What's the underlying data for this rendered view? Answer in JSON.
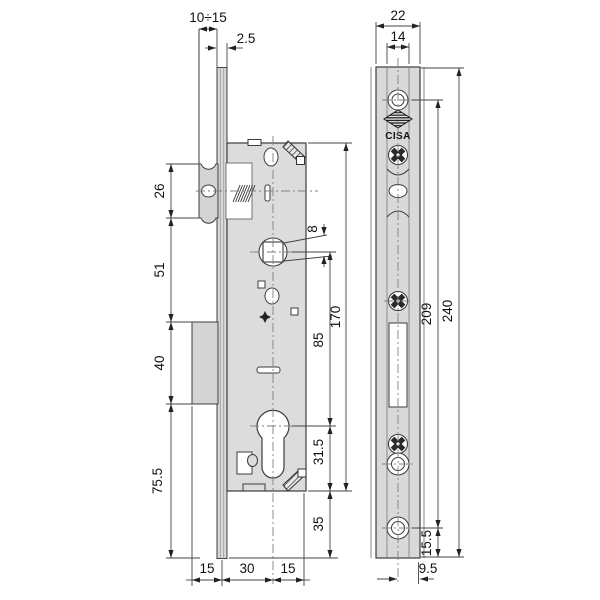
{
  "drawing": {
    "brand": "CISA",
    "colors": {
      "outline": "#3d3d3d",
      "body_fill": "#dcdcdc",
      "plate_fill": "#d9d9d9",
      "centerline": "#808080",
      "dimension": "#222222",
      "background": "#ffffff"
    },
    "left_view": {
      "dim_gap_range": "10÷15",
      "dim_plate_thickness": "2.5",
      "dim_latch_box": "26",
      "dim_latch_to_deadbolt": "51",
      "dim_deadbolt_box": "40",
      "dim_bottom_section": "75.5",
      "dim_spindle_square": "8",
      "dim_spindle_to_cylinder": "85",
      "dim_body_height": "170",
      "dim_cylinder_to_bottom": "31.5",
      "dim_below_body": "35",
      "dim_bottom_left": "15",
      "dim_backset": "30",
      "dim_bottom_right": "15"
    },
    "right_view": {
      "dim_plate_width": "22",
      "dim_inner_width": "14",
      "dim_screw_centers": "209",
      "dim_plate_length": "240",
      "dim_bottom_hole_to_edge": "15.5",
      "dim_center_to_edge": "9.5",
      "brand_label": "CISA"
    }
  }
}
